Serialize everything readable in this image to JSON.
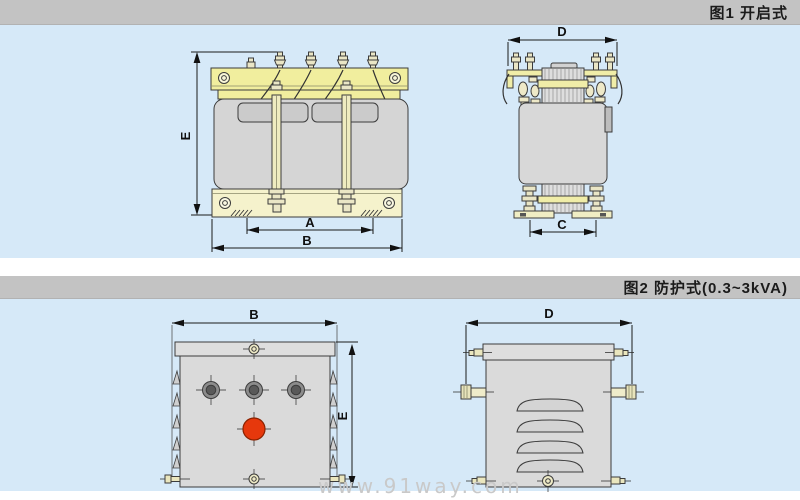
{
  "figure1": {
    "caption": "图1 开启式",
    "front_view": {
      "dim_height": "E",
      "dim_slot_span": "A",
      "dim_width": "B"
    },
    "side_view": {
      "dim_depth": "D",
      "dim_foot_span": "C"
    }
  },
  "figure2": {
    "caption": "图2 防护式(0.3~3kVA)",
    "front_view": {
      "dim_width": "B",
      "dim_height": "E"
    },
    "side_view": {
      "dim_depth": "D"
    }
  },
  "watermark": "www.91way.com",
  "colors": {
    "panel_background": "#d6e9f8",
    "caption_bar_background": "#c3c3c3",
    "clamp_yellow": "#f1ee9e",
    "base_cream": "#f5f2cc",
    "core_gray": "#d5d5d5",
    "enclosure_gray": "#dadada",
    "knob_gray": "#8c8c8c",
    "indicator_red": "#e6380c",
    "outline": "#3c3c3c",
    "watermark_gray": "#c9c9c9"
  }
}
